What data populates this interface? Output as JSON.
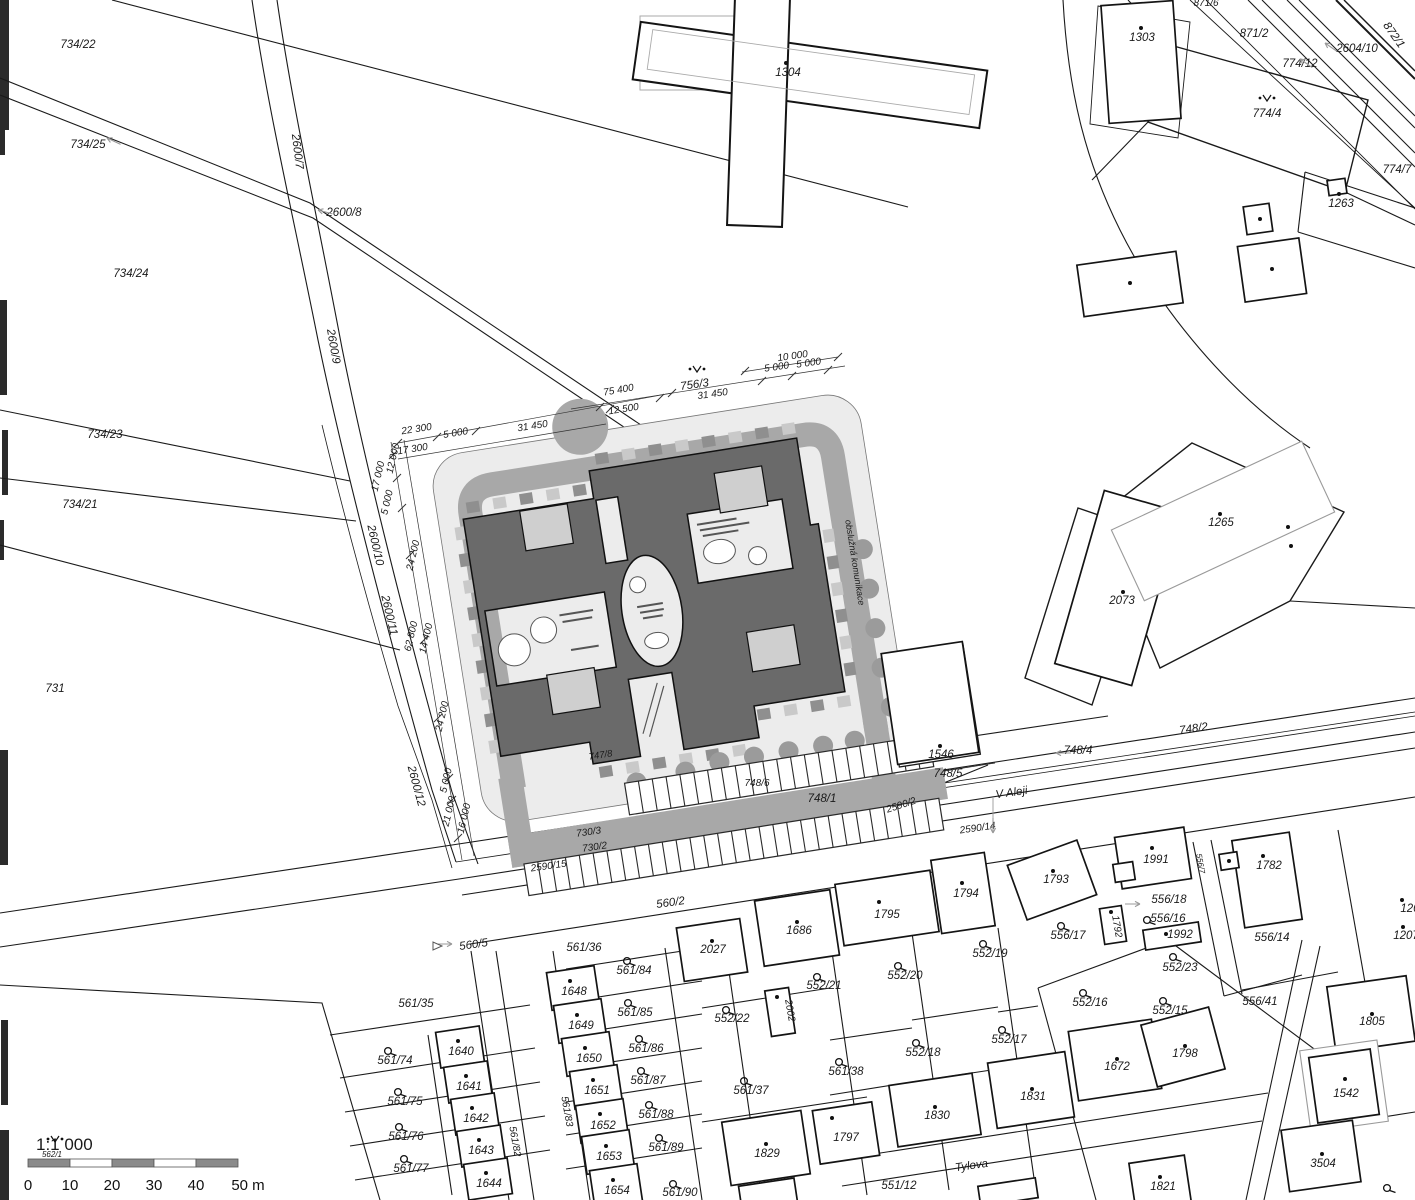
{
  "map": {
    "title": "cadastral site plan 1:1 000",
    "scale_bar": {
      "ratio": "1:1 000",
      "ticks": [
        "0",
        "10",
        "20",
        "30",
        "40"
      ],
      "end_label": "50 m"
    },
    "street_names": [
      "V Aleji",
      "Tylova"
    ],
    "service_road_label": "obslužná komunikace",
    "palette": {
      "building": "#6a6a6a",
      "band": "#a8a8a8",
      "pale": "#ececec",
      "inset": "#cfcfcf",
      "tick_dark": "#8f8f8f",
      "tick_light": "#c9c9c9",
      "tree": "#9b9b9b",
      "line": "#1a1a1a",
      "muted_text": "#b3b3b3"
    },
    "labels": [
      {
        "t": "734/22",
        "x": 78,
        "y": 48
      },
      {
        "t": "734/25",
        "x": 88,
        "y": 148
      },
      {
        "t": "2600/7",
        "x": 294,
        "y": 152,
        "r": 83
      },
      {
        "t": "2600/8",
        "x": 344,
        "y": 216
      },
      {
        "t": "734/24",
        "x": 131,
        "y": 277
      },
      {
        "t": "2600/9",
        "x": 330,
        "y": 347,
        "r": 80
      },
      {
        "t": "734/23",
        "x": 105,
        "y": 438
      },
      {
        "t": "734/21",
        "x": 80,
        "y": 508
      },
      {
        "t": "731",
        "x": 55,
        "y": 692
      },
      {
        "t": "2600/10",
        "x": 372,
        "y": 546,
        "r": 77
      },
      {
        "t": "2600/11",
        "x": 386,
        "y": 616,
        "r": 77
      },
      {
        "t": "2600/12",
        "x": 413,
        "y": 787,
        "r": 75
      },
      {
        "t": "1304",
        "x": 788,
        "y": 76
      },
      {
        "t": "871/6",
        "x": 1206,
        "y": 6,
        "s": 10
      },
      {
        "t": "1303",
        "x": 1142,
        "y": 41
      },
      {
        "t": "871/2",
        "x": 1254,
        "y": 37
      },
      {
        "t": "2604/10",
        "x": 1357,
        "y": 52
      },
      {
        "t": "872/1",
        "x": 1391,
        "y": 37,
        "r": 55
      },
      {
        "t": "774/12",
        "x": 1300,
        "y": 67
      },
      {
        "t": "774/4",
        "x": 1267,
        "y": 117
      },
      {
        "t": "774/7",
        "x": 1397,
        "y": 173
      },
      {
        "t": "1263",
        "x": 1341,
        "y": 207
      },
      {
        "t": "1265",
        "x": 1221,
        "y": 526
      },
      {
        "t": "2073",
        "x": 1122,
        "y": 604
      },
      {
        "t": "10 000",
        "x": 793,
        "y": 359,
        "r": -8,
        "s": 10,
        "k": "dim"
      },
      {
        "t": "5 000",
        "x": 777,
        "y": 370,
        "r": -8,
        "s": 10,
        "k": "dim"
      },
      {
        "t": "5 000",
        "x": 809,
        "y": 366,
        "r": -8,
        "s": 10,
        "k": "dim"
      },
      {
        "t": "756/3",
        "x": 695,
        "y": 388,
        "r": -8
      },
      {
        "t": "31 450",
        "x": 713,
        "y": 397,
        "r": -8,
        "s": 10,
        "k": "dim"
      },
      {
        "t": "75 400",
        "x": 619,
        "y": 393,
        "r": -10,
        "s": 10,
        "k": "dim"
      },
      {
        "t": "12 500",
        "x": 624,
        "y": 412,
        "r": -9,
        "s": 10,
        "k": "dim"
      },
      {
        "t": "22 300",
        "x": 417,
        "y": 432,
        "r": -9,
        "s": 10,
        "k": "dim"
      },
      {
        "t": "5 000",
        "x": 456,
        "y": 436,
        "r": -9,
        "s": 10,
        "k": "dim"
      },
      {
        "t": "31 450",
        "x": 533,
        "y": 429,
        "r": -9,
        "s": 10,
        "k": "dim"
      },
      {
        "t": "17 300",
        "x": 413,
        "y": 452,
        "r": -9,
        "s": 10,
        "k": "dim"
      },
      {
        "t": "12 000",
        "x": 396,
        "y": 459,
        "r": -77,
        "s": 10,
        "k": "dim"
      },
      {
        "t": "17 000",
        "x": 381,
        "y": 477,
        "r": -77,
        "s": 10,
        "k": "dim"
      },
      {
        "t": "5 000",
        "x": 390,
        "y": 503,
        "r": -77,
        "s": 10,
        "k": "dim"
      },
      {
        "t": "24 200",
        "x": 416,
        "y": 556,
        "r": -77,
        "s": 10,
        "k": "dim"
      },
      {
        "t": "62 800",
        "x": 414,
        "y": 637,
        "r": -77,
        "s": 10,
        "k": "dim"
      },
      {
        "t": "14 400",
        "x": 429,
        "y": 639,
        "r": -77,
        "s": 10,
        "k": "dim"
      },
      {
        "t": "24 200",
        "x": 445,
        "y": 717,
        "r": -77,
        "s": 10,
        "k": "dim"
      },
      {
        "t": "5 000",
        "x": 449,
        "y": 781,
        "r": -77,
        "s": 10,
        "k": "dim"
      },
      {
        "t": "21 000",
        "x": 452,
        "y": 812,
        "r": -77,
        "s": 10,
        "k": "dim"
      },
      {
        "t": "16 000",
        "x": 467,
        "y": 819,
        "r": -77,
        "s": 10,
        "k": "dim"
      },
      {
        "t": "obslužná komunikace",
        "x": 852,
        "y": 563,
        "r": 81,
        "s": 9,
        "c": "#b3b3b3",
        "k": "street",
        "n": "service-road-label"
      },
      {
        "t": "747/8",
        "x": 601,
        "y": 758,
        "r": -9,
        "s": 9.5
      },
      {
        "t": "748/6",
        "x": 757,
        "y": 786,
        "s": 10
      },
      {
        "t": "1546",
        "x": 941,
        "y": 758
      },
      {
        "t": "748/5",
        "x": 948,
        "y": 777
      },
      {
        "t": "748/1",
        "x": 822,
        "y": 802
      },
      {
        "t": "2590/2",
        "x": 902,
        "y": 808,
        "r": -18,
        "s": 10
      },
      {
        "t": "V Aleji",
        "x": 1012,
        "y": 796,
        "r": -8,
        "n": "street-name-v-aleji",
        "k": "street"
      },
      {
        "t": "2590/14",
        "x": 978,
        "y": 831,
        "r": -8,
        "s": 10
      },
      {
        "t": "748/4",
        "x": 1078,
        "y": 754
      },
      {
        "t": "748/2",
        "x": 1194,
        "y": 732,
        "r": -8
      },
      {
        "t": "730/3",
        "x": 589,
        "y": 835,
        "r": -8,
        "s": 10
      },
      {
        "t": "730/2",
        "x": 595,
        "y": 850,
        "r": -8,
        "s": 10
      },
      {
        "t": "2590/15",
        "x": 549,
        "y": 869,
        "r": -8,
        "s": 10
      },
      {
        "t": "560/2",
        "x": 671,
        "y": 906,
        "r": -8
      },
      {
        "t": "560/5",
        "x": 474,
        "y": 948,
        "r": -8
      },
      {
        "t": "561/36",
        "x": 584,
        "y": 951
      },
      {
        "t": "561/84",
        "x": 634,
        "y": 974
      },
      {
        "t": "2027",
        "x": 713,
        "y": 953
      },
      {
        "t": "1648",
        "x": 574,
        "y": 995
      },
      {
        "t": "561/85",
        "x": 635,
        "y": 1016
      },
      {
        "t": "552/22",
        "x": 732,
        "y": 1022
      },
      {
        "t": "1649",
        "x": 581,
        "y": 1029
      },
      {
        "t": "1650",
        "x": 589,
        "y": 1062
      },
      {
        "t": "561/86",
        "x": 646,
        "y": 1052
      },
      {
        "t": "1651",
        "x": 597,
        "y": 1094
      },
      {
        "t": "561/87",
        "x": 648,
        "y": 1084
      },
      {
        "t": "1652",
        "x": 603,
        "y": 1129
      },
      {
        "t": "561/88",
        "x": 656,
        "y": 1118
      },
      {
        "t": "1653",
        "x": 609,
        "y": 1160
      },
      {
        "t": "561/89",
        "x": 666,
        "y": 1151
      },
      {
        "t": "1654",
        "x": 617,
        "y": 1194
      },
      {
        "t": "561/90",
        "x": 680,
        "y": 1196
      },
      {
        "t": "561/35",
        "x": 416,
        "y": 1007
      },
      {
        "t": "561/74",
        "x": 395,
        "y": 1064
      },
      {
        "t": "1640",
        "x": 461,
        "y": 1055
      },
      {
        "t": "561/75",
        "x": 405,
        "y": 1105
      },
      {
        "t": "1641",
        "x": 469,
        "y": 1090
      },
      {
        "t": "561/76",
        "x": 406,
        "y": 1140
      },
      {
        "t": "1642",
        "x": 476,
        "y": 1122
      },
      {
        "t": "561/77",
        "x": 411,
        "y": 1172
      },
      {
        "t": "1643",
        "x": 481,
        "y": 1154
      },
      {
        "t": "1644",
        "x": 489,
        "y": 1187
      },
      {
        "t": "561/82",
        "x": 512,
        "y": 1142,
        "r": 80,
        "s": 10
      },
      {
        "t": "561/83",
        "x": 564,
        "y": 1112,
        "r": 80,
        "s": 10
      },
      {
        "t": "1686",
        "x": 799,
        "y": 934
      },
      {
        "t": "552/21",
        "x": 824,
        "y": 989
      },
      {
        "t": "2002",
        "x": 787,
        "y": 1011,
        "r": 80,
        "s": 10
      },
      {
        "t": "561/37",
        "x": 751,
        "y": 1094
      },
      {
        "t": "1829",
        "x": 767,
        "y": 1157
      },
      {
        "t": "561/38",
        "x": 846,
        "y": 1075
      },
      {
        "t": "1797",
        "x": 846,
        "y": 1141
      },
      {
        "t": "1795",
        "x": 887,
        "y": 918
      },
      {
        "t": "552/20",
        "x": 905,
        "y": 979
      },
      {
        "t": "1794",
        "x": 966,
        "y": 897
      },
      {
        "t": "552/19",
        "x": 990,
        "y": 957
      },
      {
        "t": "552/18",
        "x": 923,
        "y": 1056
      },
      {
        "t": "1830",
        "x": 937,
        "y": 1119
      },
      {
        "t": "552/17",
        "x": 1009,
        "y": 1043
      },
      {
        "t": "1831",
        "x": 1033,
        "y": 1100
      },
      {
        "t": "Tylova",
        "x": 972,
        "y": 1169,
        "r": -8,
        "n": "street-name-tylova",
        "k": "street"
      },
      {
        "t": "551/12",
        "x": 899,
        "y": 1189
      },
      {
        "t": "1672",
        "x": 1117,
        "y": 1070
      },
      {
        "t": "552/16",
        "x": 1090,
        "y": 1006
      },
      {
        "t": "552/15",
        "x": 1170,
        "y": 1014
      },
      {
        "t": "1798",
        "x": 1185,
        "y": 1057
      },
      {
        "t": "556/17",
        "x": 1068,
        "y": 939
      },
      {
        "t": "1793",
        "x": 1056,
        "y": 883
      },
      {
        "t": "1991",
        "x": 1156,
        "y": 863
      },
      {
        "t": "1792",
        "x": 1114,
        "y": 927,
        "r": 80,
        "s": 10
      },
      {
        "t": "556/18",
        "x": 1169,
        "y": 903
      },
      {
        "t": "556/16",
        "x": 1168,
        "y": 922
      },
      {
        "t": "1992",
        "x": 1180,
        "y": 938
      },
      {
        "t": "552/23",
        "x": 1180,
        "y": 971
      },
      {
        "t": "556/14",
        "x": 1272,
        "y": 941
      },
      {
        "t": "556/41",
        "x": 1260,
        "y": 1005
      },
      {
        "t": "1782",
        "x": 1269,
        "y": 869
      },
      {
        "t": "556/7",
        "x": 1198,
        "y": 864,
        "r": 80,
        "s": 8
      },
      {
        "t": "1805",
        "x": 1372,
        "y": 1025
      },
      {
        "t": "1542",
        "x": 1346,
        "y": 1097
      },
      {
        "t": "3504",
        "x": 1323,
        "y": 1167
      },
      {
        "t": "1821",
        "x": 1163,
        "y": 1190
      },
      {
        "t": "1207",
        "x": 1406,
        "y": 939
      },
      {
        "t": "120",
        "x": 1410,
        "y": 912
      },
      {
        "t": "562/1",
        "x": 52,
        "y": 1157,
        "s": 8
      },
      {
        "t": "1:1 000",
        "x": 36,
        "y": 1150,
        "s": 17,
        "up": true,
        "anchor": "start",
        "n": "scale-ratio",
        "k": "scale"
      }
    ],
    "symbols": [
      {
        "k": "dot",
        "x": 786,
        "y": 63
      },
      {
        "k": "dot",
        "x": 1141,
        "y": 28
      },
      {
        "k": "dot",
        "x": 1339,
        "y": 194
      },
      {
        "k": "dot",
        "x": 1130,
        "y": 283
      },
      {
        "k": "dot",
        "x": 1272,
        "y": 269
      },
      {
        "k": "dot",
        "x": 1260,
        "y": 219
      },
      {
        "k": "dot",
        "x": 1220,
        "y": 514
      },
      {
        "k": "dot",
        "x": 1288,
        "y": 527
      },
      {
        "k": "dot",
        "x": 1291,
        "y": 546
      },
      {
        "k": "dot",
        "x": 1123,
        "y": 592
      },
      {
        "k": "dot",
        "x": 940,
        "y": 746
      },
      {
        "k": "dot",
        "x": 712,
        "y": 941
      },
      {
        "k": "dot",
        "x": 797,
        "y": 922
      },
      {
        "k": "dot",
        "x": 879,
        "y": 902
      },
      {
        "k": "dot",
        "x": 962,
        "y": 883
      },
      {
        "k": "dot",
        "x": 1053,
        "y": 871
      },
      {
        "k": "dot",
        "x": 1152,
        "y": 848
      },
      {
        "k": "dot",
        "x": 1263,
        "y": 856
      },
      {
        "k": "dot",
        "x": 1229,
        "y": 861
      },
      {
        "k": "dot",
        "x": 1111,
        "y": 912
      },
      {
        "k": "dot",
        "x": 1166,
        "y": 934
      },
      {
        "k": "dot",
        "x": 766,
        "y": 1144
      },
      {
        "k": "dot",
        "x": 832,
        "y": 1118
      },
      {
        "k": "dot",
        "x": 935,
        "y": 1107
      },
      {
        "k": "dot",
        "x": 1032,
        "y": 1089
      },
      {
        "k": "dot",
        "x": 1117,
        "y": 1059
      },
      {
        "k": "dot",
        "x": 1185,
        "y": 1046
      },
      {
        "k": "dot",
        "x": 1372,
        "y": 1014
      },
      {
        "k": "dot",
        "x": 1345,
        "y": 1079
      },
      {
        "k": "dot",
        "x": 1322,
        "y": 1154
      },
      {
        "k": "dot",
        "x": 1160,
        "y": 1177
      },
      {
        "k": "dot",
        "x": 1403,
        "y": 927
      },
      {
        "k": "dot",
        "x": 1402,
        "y": 900
      },
      {
        "k": "dot",
        "x": 777,
        "y": 997
      },
      {
        "k": "dot",
        "x": 458,
        "y": 1041
      },
      {
        "k": "dot",
        "x": 466,
        "y": 1076
      },
      {
        "k": "dot",
        "x": 472,
        "y": 1108
      },
      {
        "k": "dot",
        "x": 479,
        "y": 1140
      },
      {
        "k": "dot",
        "x": 486,
        "y": 1173
      },
      {
        "k": "dot",
        "x": 570,
        "y": 981
      },
      {
        "k": "dot",
        "x": 577,
        "y": 1015
      },
      {
        "k": "dot",
        "x": 585,
        "y": 1048
      },
      {
        "k": "dot",
        "x": 593,
        "y": 1080
      },
      {
        "k": "dot",
        "x": 600,
        "y": 1114
      },
      {
        "k": "dot",
        "x": 606,
        "y": 1146
      },
      {
        "k": "dot",
        "x": 613,
        "y": 1180
      },
      {
        "k": "hook",
        "x": 627,
        "y": 961
      },
      {
        "k": "hook",
        "x": 628,
        "y": 1003
      },
      {
        "k": "hook",
        "x": 639,
        "y": 1039
      },
      {
        "k": "hook",
        "x": 641,
        "y": 1071
      },
      {
        "k": "hook",
        "x": 649,
        "y": 1105
      },
      {
        "k": "hook",
        "x": 659,
        "y": 1138
      },
      {
        "k": "hook",
        "x": 673,
        "y": 1184
      },
      {
        "k": "hook",
        "x": 388,
        "y": 1051
      },
      {
        "k": "hook",
        "x": 398,
        "y": 1092
      },
      {
        "k": "hook",
        "x": 399,
        "y": 1127
      },
      {
        "k": "hook",
        "x": 404,
        "y": 1159
      },
      {
        "k": "hook",
        "x": 726,
        "y": 1010
      },
      {
        "k": "hook",
        "x": 744,
        "y": 1081
      },
      {
        "k": "hook",
        "x": 817,
        "y": 977
      },
      {
        "k": "hook",
        "x": 839,
        "y": 1062
      },
      {
        "k": "hook",
        "x": 898,
        "y": 966
      },
      {
        "k": "hook",
        "x": 983,
        "y": 944
      },
      {
        "k": "hook",
        "x": 916,
        "y": 1043
      },
      {
        "k": "hook",
        "x": 1002,
        "y": 1030
      },
      {
        "k": "hook",
        "x": 1083,
        "y": 993
      },
      {
        "k": "hook",
        "x": 1163,
        "y": 1001
      },
      {
        "k": "hook",
        "x": 1061,
        "y": 926
      },
      {
        "k": "hook",
        "x": 1147,
        "y": 920
      },
      {
        "k": "hook",
        "x": 1173,
        "y": 957
      },
      {
        "k": "hook",
        "x": 1387,
        "y": 1188
      },
      {
        "k": "vee",
        "x": 697,
        "y": 370
      },
      {
        "k": "vee",
        "x": 1267,
        "y": 99
      },
      {
        "k": "vee",
        "x": 55,
        "y": 1140
      },
      {
        "k": "arrow",
        "x": 107,
        "y": 138,
        "r": 205
      },
      {
        "k": "arrow",
        "x": 318,
        "y": 210,
        "r": 195
      },
      {
        "k": "arrow",
        "x": 452,
        "y": 944,
        "r": 0
      },
      {
        "k": "arrow",
        "x": 1056,
        "y": 753,
        "r": 180
      },
      {
        "k": "arrow",
        "x": 1140,
        "y": 904,
        "r": 0
      },
      {
        "k": "arrow",
        "x": 1325,
        "y": 43,
        "r": 215
      },
      {
        "k": "arrow",
        "x": 1300,
        "y": 59,
        "r": 215
      },
      {
        "k": "arrow",
        "x": 993,
        "y": 833,
        "r": 90
      },
      {
        "k": "tri",
        "x": 437,
        "y": 946,
        "r": 0
      }
    ]
  }
}
